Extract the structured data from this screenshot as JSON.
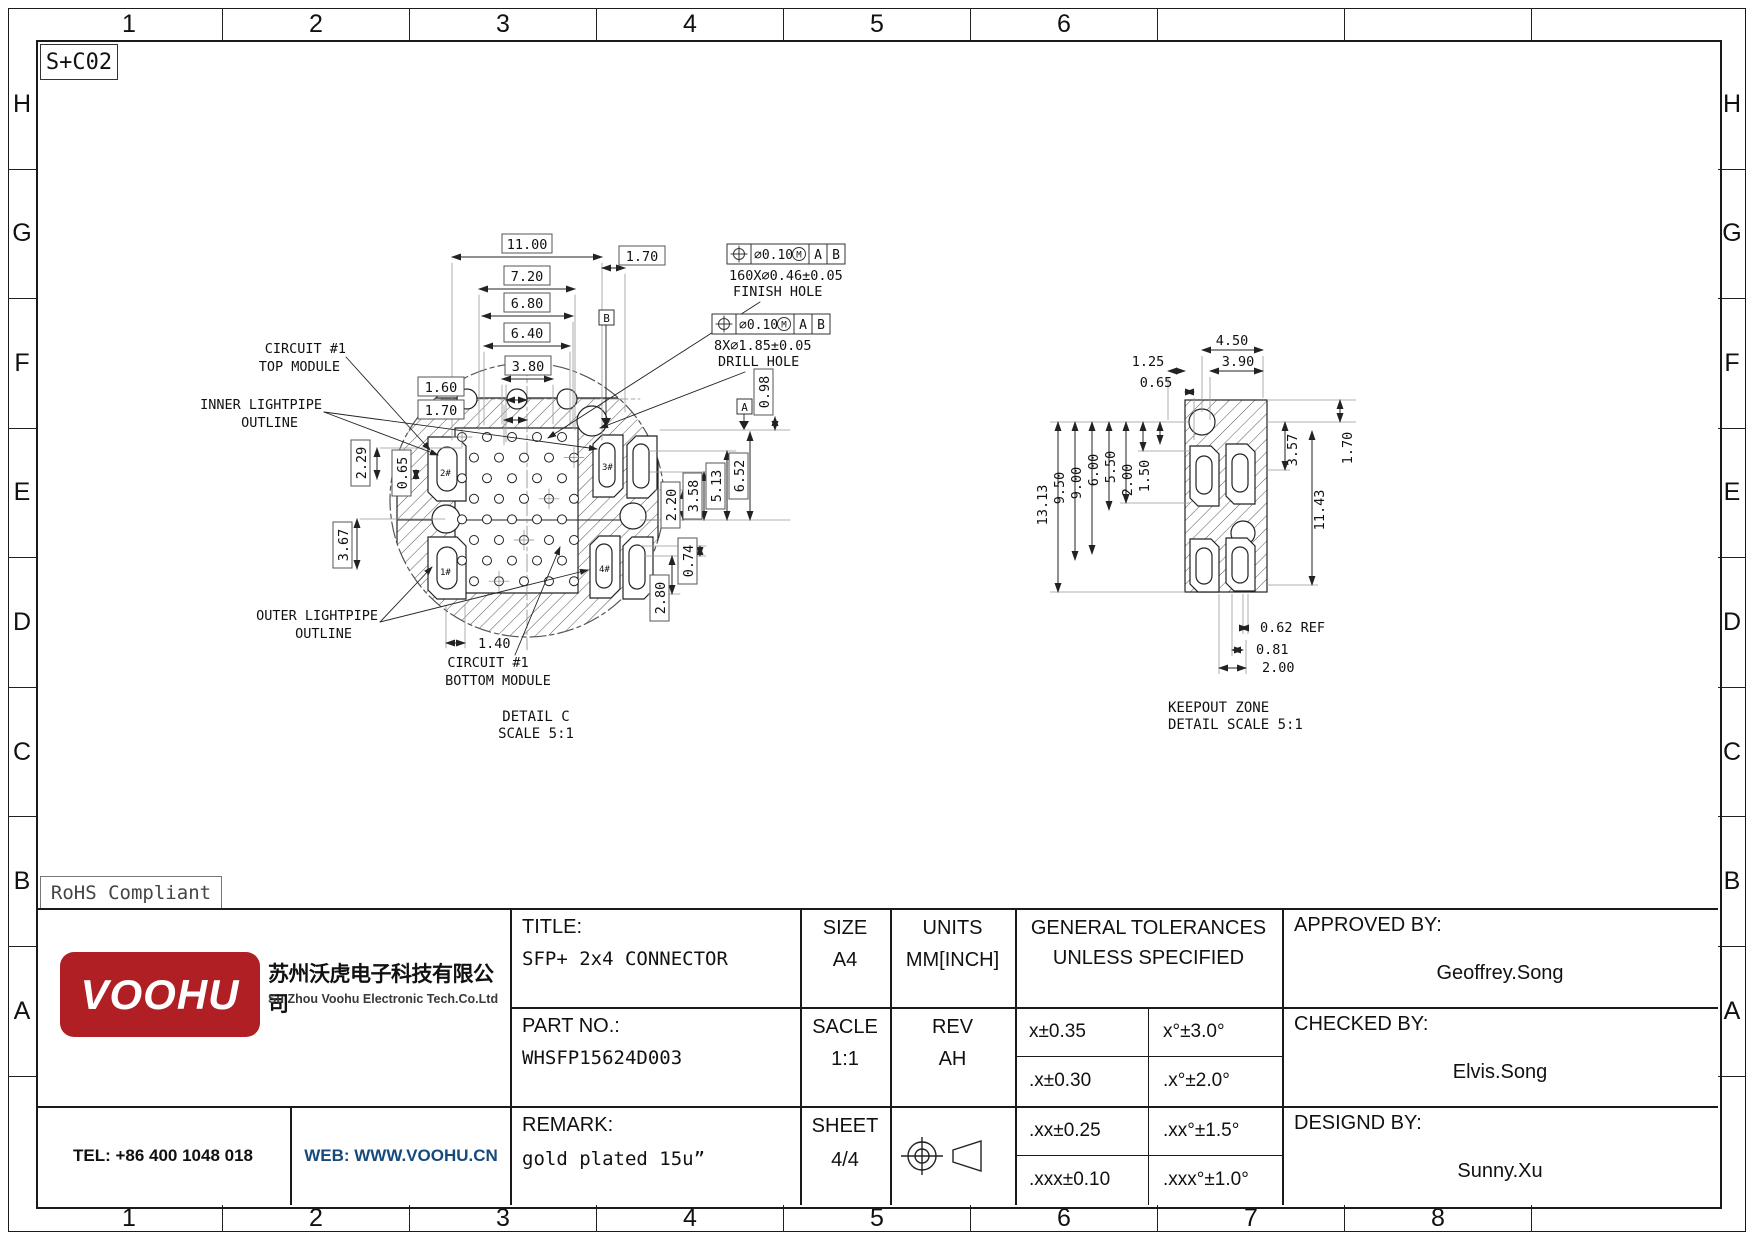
{
  "frame": {
    "zone_ref": "S+C02",
    "rohs": "RoHS Compliant",
    "cols": [
      "1",
      "2",
      "3",
      "4",
      "5",
      "6",
      "7",
      "8"
    ],
    "rows": [
      "H",
      "G",
      "F",
      "E",
      "D",
      "C",
      "B",
      "A"
    ]
  },
  "detail_c": {
    "caption1": "DETAIL C",
    "caption2": "SCALE 5:1",
    "slots": [
      "2#",
      "3#",
      "1#",
      "4#"
    ],
    "datum_a": "A",
    "datum_b": "B",
    "fcf_finish": {
      "tol": "∅0.10",
      "m": "M",
      "d1": "A",
      "d2": "B",
      "qty": "160X∅0.46±0.05",
      "name": "FINISH HOLE"
    },
    "fcf_drill": {
      "tol": "∅0.10",
      "m": "M",
      "d1": "A",
      "d2": "B",
      "qty": "8X∅1.85±0.05",
      "name": "DRILL HOLE"
    },
    "labels": {
      "top1": "CIRCUIT #1",
      "top2": "TOP MODULE",
      "inner1": "INNER LIGHTPIPE",
      "inner2": "OUTLINE",
      "outer1": "OUTER LIGHTPIPE",
      "outer2": "OUTLINE",
      "bottom1": "CIRCUIT #1",
      "bottom2": "BOTTOM MODULE"
    },
    "dims": {
      "w11": "11.00",
      "w72": "7.20",
      "w68": "6.80",
      "w64": "6.40",
      "w38": "3.80",
      "w16": "1.60",
      "w17l": "1.70",
      "w17r": "1.70",
      "h229": "2.29",
      "h065": "0.65",
      "h367": "3.67",
      "w14": "1.40",
      "h098": "0.98",
      "h652": "6.52",
      "h513": "5.13",
      "h358": "3.58",
      "h220": "2.20",
      "h074": "0.74",
      "h280": "2.80"
    }
  },
  "keepout": {
    "caption1": "KEEPOUT ZONE",
    "caption2": "DETAIL SCALE 5:1",
    "dims": {
      "w450": "4.50",
      "w390": "3.90",
      "w125": "1.25",
      "w065": "0.65",
      "h1313": "13.13",
      "h950": "9.50",
      "h900": "9.00",
      "h600": "6.00",
      "h550": "5.50",
      "h200": "2.00",
      "h150": "1.50",
      "r357": "3.57",
      "r1143": "11.43",
      "r170": "1.70",
      "b062": "0.62 REF",
      "b081": "0.81",
      "b200": "2.00"
    }
  },
  "title_block": {
    "title_label": "TITLE:",
    "title_value": "SFP+ 2x4 CONNECTOR",
    "part_label": "PART NO.:",
    "part_value": "WHSFP15624D003",
    "remark_label": "REMARK:",
    "remark_value": "gold plated 15u”",
    "size_label": "SIZE",
    "size_value": "A4",
    "scale_label": "SACLE",
    "scale_value": "1:1",
    "sheet_label": "SHEET",
    "sheet_value": "4/4",
    "units_label": "UNITS",
    "units_value": "MM[INCH]",
    "rev_label": "REV",
    "rev_value": "AH",
    "tol_header1": "GENERAL TOLERANCES",
    "tol_header2": "UNLESS SPECIFIED",
    "tolerances": [
      [
        "x±0.35",
        "x°±3.0°"
      ],
      [
        ".x±0.30",
        ".x°±2.0°"
      ],
      [
        ".xx±0.25",
        ".xx°±1.5°"
      ],
      [
        ".xxx±0.10",
        ".xxx°±1.0°"
      ]
    ],
    "approved_label": "APPROVED BY:",
    "approved_value": "Geoffrey.Song",
    "checked_label": "CHECKED BY:",
    "checked_value": "Elvis.Song",
    "designed_label": "DESIGND BY:",
    "designed_value": "Sunny.Xu"
  },
  "company": {
    "logo_text": "VOOHU",
    "name_cn": "苏州沃虎电子科技有限公司",
    "name_en": "Su Zhou Voohu Electronic Tech.Co.Ltd",
    "tel": "TEL: +86 400 1048 018",
    "web": "WEB: WWW.VOOHU.CN",
    "brand_red": "#b01f24",
    "web_blue": "#164a7c"
  }
}
